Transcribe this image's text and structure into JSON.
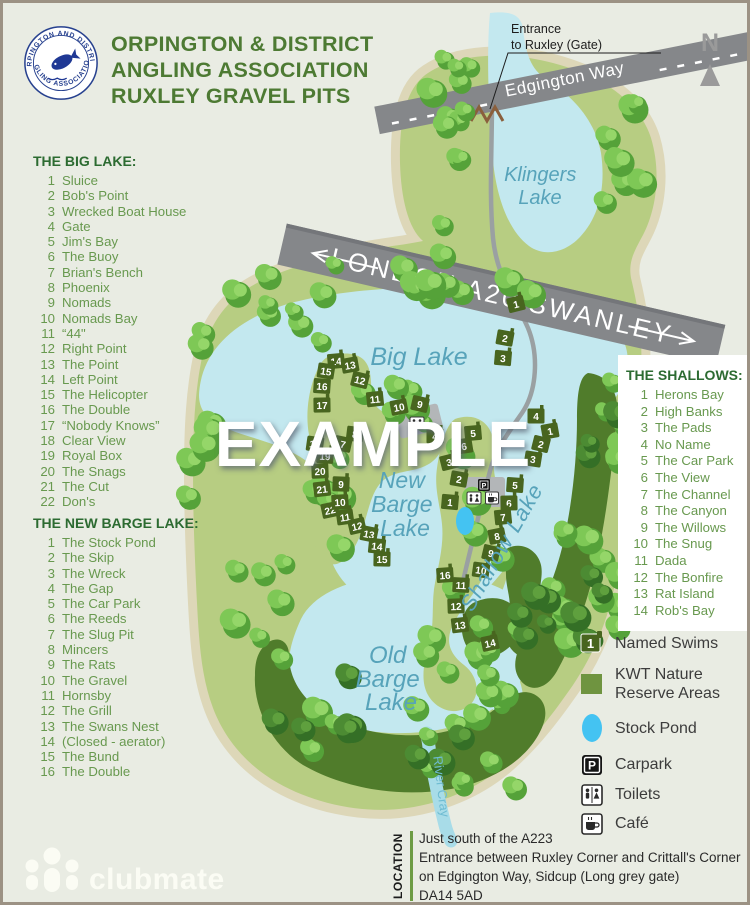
{
  "header": {
    "title_line1": "ORPINGTON & DISTRICT",
    "title_line2": "ANGLING ASSOCIATION",
    "title_line3": "RUXLEY GRAVEL PITS",
    "badge_top": "ORPINGTON AND DISTRICT",
    "badge_bottom": "ANGLING ASSOCIATION"
  },
  "compass": {
    "label": "N"
  },
  "watermark": "EXAMPLE",
  "entrance": {
    "line1": "Entrance",
    "line2": "to Ruxley (Gate)"
  },
  "roads": {
    "edgington": "Edgington Way",
    "a20": "LONDON  A20  SWANLEY"
  },
  "lakes": {
    "klingers": [
      "Klingers",
      "Lake"
    ],
    "big": "Big Lake",
    "new_barge": [
      "New",
      "Barge",
      "Lake"
    ],
    "shallow": "Shallow  Lake",
    "old_barge": [
      "Old",
      "Barge",
      "Lake"
    ],
    "river": "River Cray"
  },
  "lists": {
    "big_lake": {
      "title": "THE BIG LAKE:",
      "items": [
        "Sluice",
        "Bob's Point",
        "Wrecked Boat House",
        "Gate",
        "Jim's Bay",
        "The Buoy",
        "Brian's Bench",
        "Phoenix",
        "Nomads",
        "Nomads Bay",
        "“44\"",
        "Right Point",
        "The Point",
        "Left Point",
        "The Helicopter",
        "The Double",
        "“Nobody Knows”",
        "Clear View",
        "Royal Box",
        "The Snags",
        "The Cut",
        "Don's"
      ]
    },
    "new_barge": {
      "title": "THE NEW BARGE LAKE:",
      "items": [
        "The Stock Pond",
        "The Skip",
        "The Wreck",
        "The Gap",
        "The Car Park",
        "The Reeds",
        "The Slug Pit",
        "Mincers",
        "The Rats",
        "The Gravel",
        "Hornsby",
        "The Grill",
        "The Swans Nest",
        "(Closed - aerator)",
        "The Bund",
        "The Double"
      ]
    },
    "shallows": {
      "title": "THE SHALLOWS:",
      "items": [
        "Herons Bay",
        "High Banks",
        "The Pads",
        "No Name",
        "The Car Park",
        "The View",
        "The Channel",
        "The Canyon",
        "The Willows",
        "The Snug",
        "Dada",
        "The Bonfire",
        "Rat Island",
        "Rob's Bay"
      ]
    }
  },
  "legend": {
    "items": [
      {
        "icon": "swim-marker-icon",
        "label": "Named Swims"
      },
      {
        "icon": "reserve-square-icon",
        "label": "KWT Nature Reserve Areas"
      },
      {
        "icon": "stock-pond-icon",
        "label": "Stock Pond"
      },
      {
        "icon": "carpark-icon",
        "label": "Carpark"
      },
      {
        "icon": "toilets-icon",
        "label": "Toilets"
      },
      {
        "icon": "cafe-icon",
        "label": "Café"
      }
    ],
    "swim_sample_number": "1"
  },
  "footer": {
    "brand": "clubmate",
    "location_label": "LOCATION",
    "lines": [
      "Just south of the A223",
      "Entrance between Ruxley Corner and Crittall's Corner",
      "on Edgington Way, Sidcup (Long grey gate)",
      "DA14 5AD"
    ]
  },
  "map": {
    "colors": {
      "background": "#e9ece3",
      "land": "#b7cd82",
      "land_edge": "#ddd7b8",
      "water": "#c3e8ef",
      "reserve": "#507c2b",
      "road": "#85878a",
      "path": "#9aa0a2",
      "marker": "#48651f",
      "pond": "#44c3f2",
      "lake_label": "#57a3ba",
      "title_green": "#4d7a33"
    },
    "markers": [
      {
        "n": "1",
        "x": 513,
        "y": 301
      },
      {
        "n": "2",
        "x": 502,
        "y": 335
      },
      {
        "n": "3",
        "x": 500,
        "y": 355
      },
      {
        "n": "4",
        "x": 533,
        "y": 413
      },
      {
        "n": "14",
        "x": 333,
        "y": 358
      },
      {
        "n": "13",
        "x": 347,
        "y": 362
      },
      {
        "n": "12",
        "x": 357,
        "y": 377
      },
      {
        "n": "15",
        "x": 323,
        "y": 368
      },
      {
        "n": "16",
        "x": 319,
        "y": 383
      },
      {
        "n": "17",
        "x": 319,
        "y": 402
      },
      {
        "n": "11",
        "x": 372,
        "y": 396
      },
      {
        "n": "10",
        "x": 396,
        "y": 404
      },
      {
        "n": "9",
        "x": 417,
        "y": 401
      },
      {
        "n": "18",
        "x": 312,
        "y": 441
      },
      {
        "n": "19",
        "x": 322,
        "y": 453
      },
      {
        "n": "20",
        "x": 317,
        "y": 468
      },
      {
        "n": "21",
        "x": 319,
        "y": 486
      },
      {
        "n": "22",
        "x": 327,
        "y": 507
      },
      {
        "n": "7",
        "x": 340,
        "y": 441
      },
      {
        "n": "8",
        "x": 352,
        "y": 431
      },
      {
        "n": "9",
        "x": 338,
        "y": 481
      },
      {
        "n": "10",
        "x": 337,
        "y": 499
      },
      {
        "n": "11",
        "x": 342,
        "y": 514
      },
      {
        "n": "12",
        "x": 354,
        "y": 523
      },
      {
        "n": "13",
        "x": 366,
        "y": 531
      },
      {
        "n": "14",
        "x": 374,
        "y": 543
      },
      {
        "n": "15",
        "x": 379,
        "y": 556
      },
      {
        "n": "16",
        "x": 442,
        "y": 572
      },
      {
        "n": "6",
        "x": 461,
        "y": 443
      },
      {
        "n": "3",
        "x": 446,
        "y": 459
      },
      {
        "n": "2",
        "x": 456,
        "y": 476
      },
      {
        "n": "1",
        "x": 447,
        "y": 499
      },
      {
        "n": "4",
        "x": 432,
        "y": 433
      },
      {
        "n": "5",
        "x": 470,
        "y": 430
      },
      {
        "n": "1",
        "x": 547,
        "y": 428
      },
      {
        "n": "2",
        "x": 538,
        "y": 441
      },
      {
        "n": "3",
        "x": 530,
        "y": 456
      },
      {
        "n": "5",
        "x": 512,
        "y": 482
      },
      {
        "n": "6",
        "x": 506,
        "y": 500
      },
      {
        "n": "7",
        "x": 500,
        "y": 514
      },
      {
        "n": "8",
        "x": 494,
        "y": 533
      },
      {
        "n": "9",
        "x": 488,
        "y": 550
      },
      {
        "n": "10",
        "x": 478,
        "y": 567
      },
      {
        "n": "11",
        "x": 458,
        "y": 582
      },
      {
        "n": "12",
        "x": 453,
        "y": 603
      },
      {
        "n": "13",
        "x": 457,
        "y": 622
      },
      {
        "n": "14",
        "x": 487,
        "y": 640
      }
    ]
  }
}
